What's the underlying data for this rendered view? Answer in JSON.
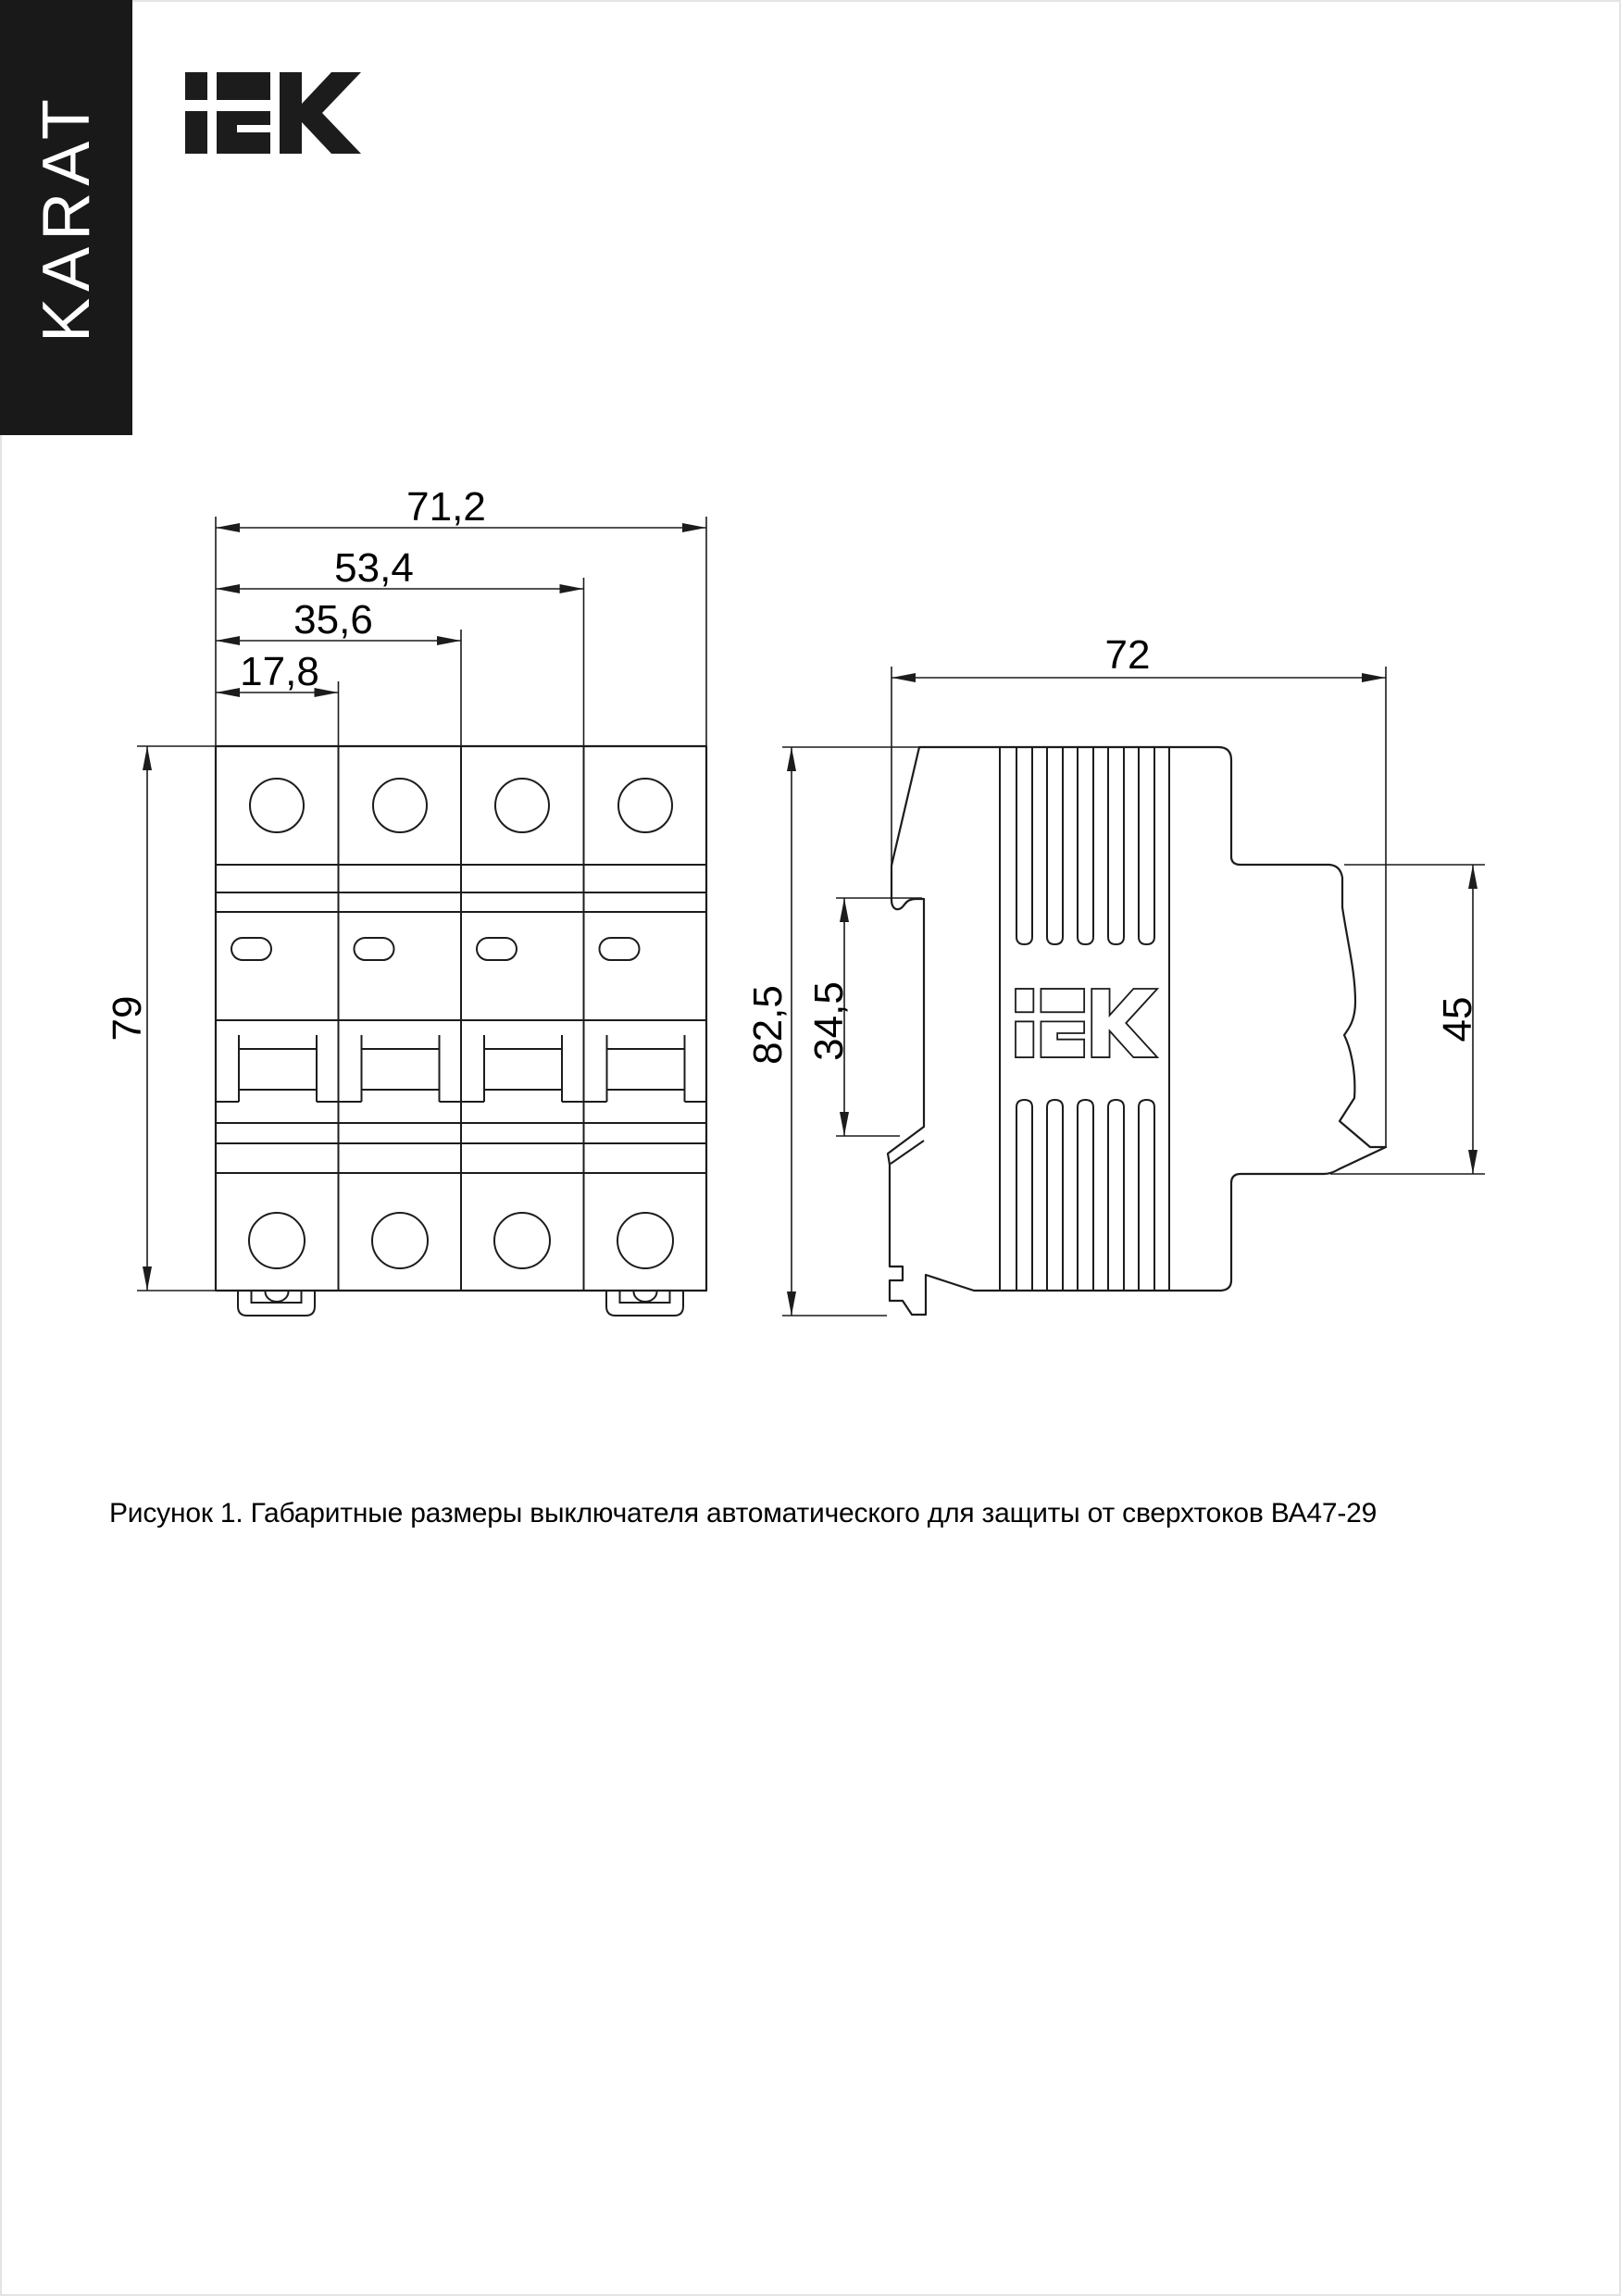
{
  "brand": {
    "banner_text": "KARAT",
    "logo_name": "IEK"
  },
  "figure": {
    "caption": "Рисунок 1. Габаритные размеры выключателя автоматического для защиты от сверхтоков ВА47-29",
    "product": "ВА47-29",
    "views": {
      "front": {
        "title": "front-view-4-pole-breaker",
        "dimensions": {
          "total_width_mm": "71,2",
          "three_module_width_mm": "53,4",
          "two_module_width_mm": "35,6",
          "one_module_width_mm": "17,8",
          "height_mm": "79"
        }
      },
      "side": {
        "title": "side-view-breaker-profile",
        "dimensions": {
          "depth_mm": "72",
          "total_height_mm": "82,5",
          "din_zone_height_mm": "34,5",
          "front_part_height_mm": "45"
        }
      }
    }
  },
  "colors": {
    "line": "#1c1c1c",
    "banner_bg": "#191919",
    "banner_fg": "#ffffff",
    "text": "#000000",
    "page_bg": "#ffffff"
  }
}
